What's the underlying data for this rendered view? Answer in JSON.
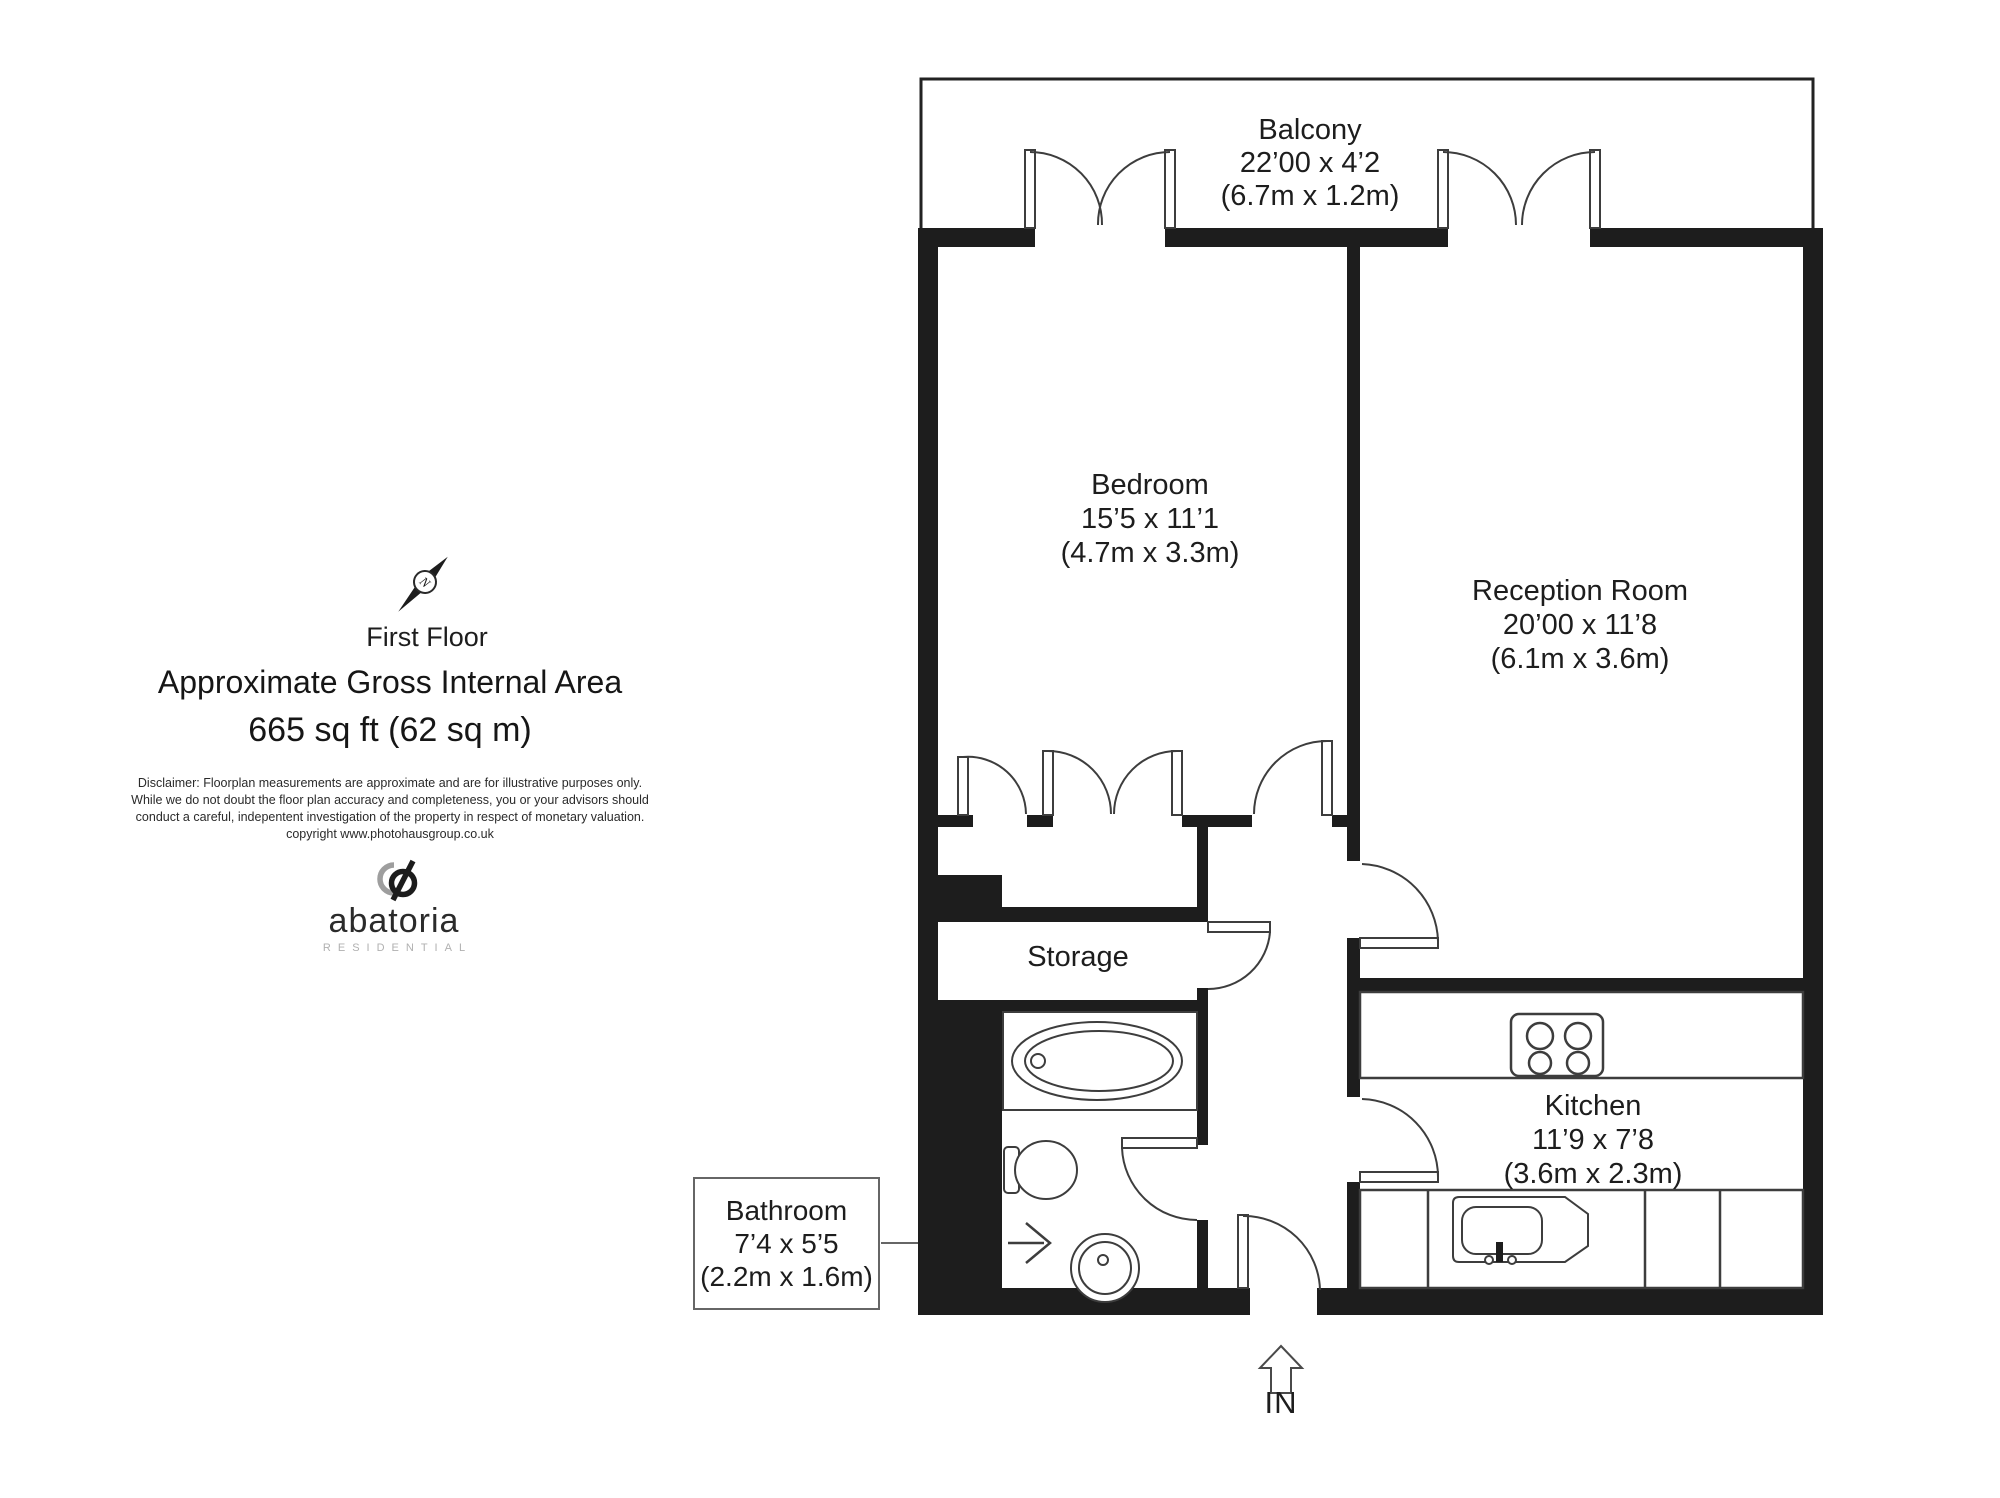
{
  "summary": {
    "floor": "First Floor",
    "title": "Approximate Gross Internal Area",
    "area": "665 sq ft (62 sq m)",
    "disclaimer_line1": "Disclaimer: Floorplan measurements are approximate and are for illustrative purposes only.",
    "disclaimer_line2": "While we do not doubt the floor plan accuracy and completeness, you or your advisors should",
    "disclaimer_line3": "conduct a careful, indepentent investigation of the property in respect of monetary valuation.",
    "disclaimer_line4": "copyright www.photohausgroup.co.uk"
  },
  "brand": {
    "name": "abatoria",
    "tagline": "RESIDENTIAL"
  },
  "compass": {
    "label": "N"
  },
  "entrance": {
    "label": "IN"
  },
  "rooms": {
    "balcony": {
      "name": "Balcony",
      "imperial": "22’00 x 4’2",
      "metric": "(6.7m x 1.2m)"
    },
    "bedroom": {
      "name": "Bedroom",
      "imperial": "15’5 x 11’1",
      "metric": "(4.7m x 3.3m)"
    },
    "reception": {
      "name": "Reception Room",
      "imperial": "20’00 x 11’8",
      "metric": "(6.1m x 3.6m)"
    },
    "kitchen": {
      "name": "Kitchen",
      "imperial": "11’9 x 7’8",
      "metric": "(3.6m x 2.3m)"
    },
    "storage": {
      "name": "Storage"
    },
    "bathroom": {
      "name": "Bathroom",
      "imperial": "7’4 x 5’5",
      "metric": "(2.2m x 1.6m)"
    }
  }
}
